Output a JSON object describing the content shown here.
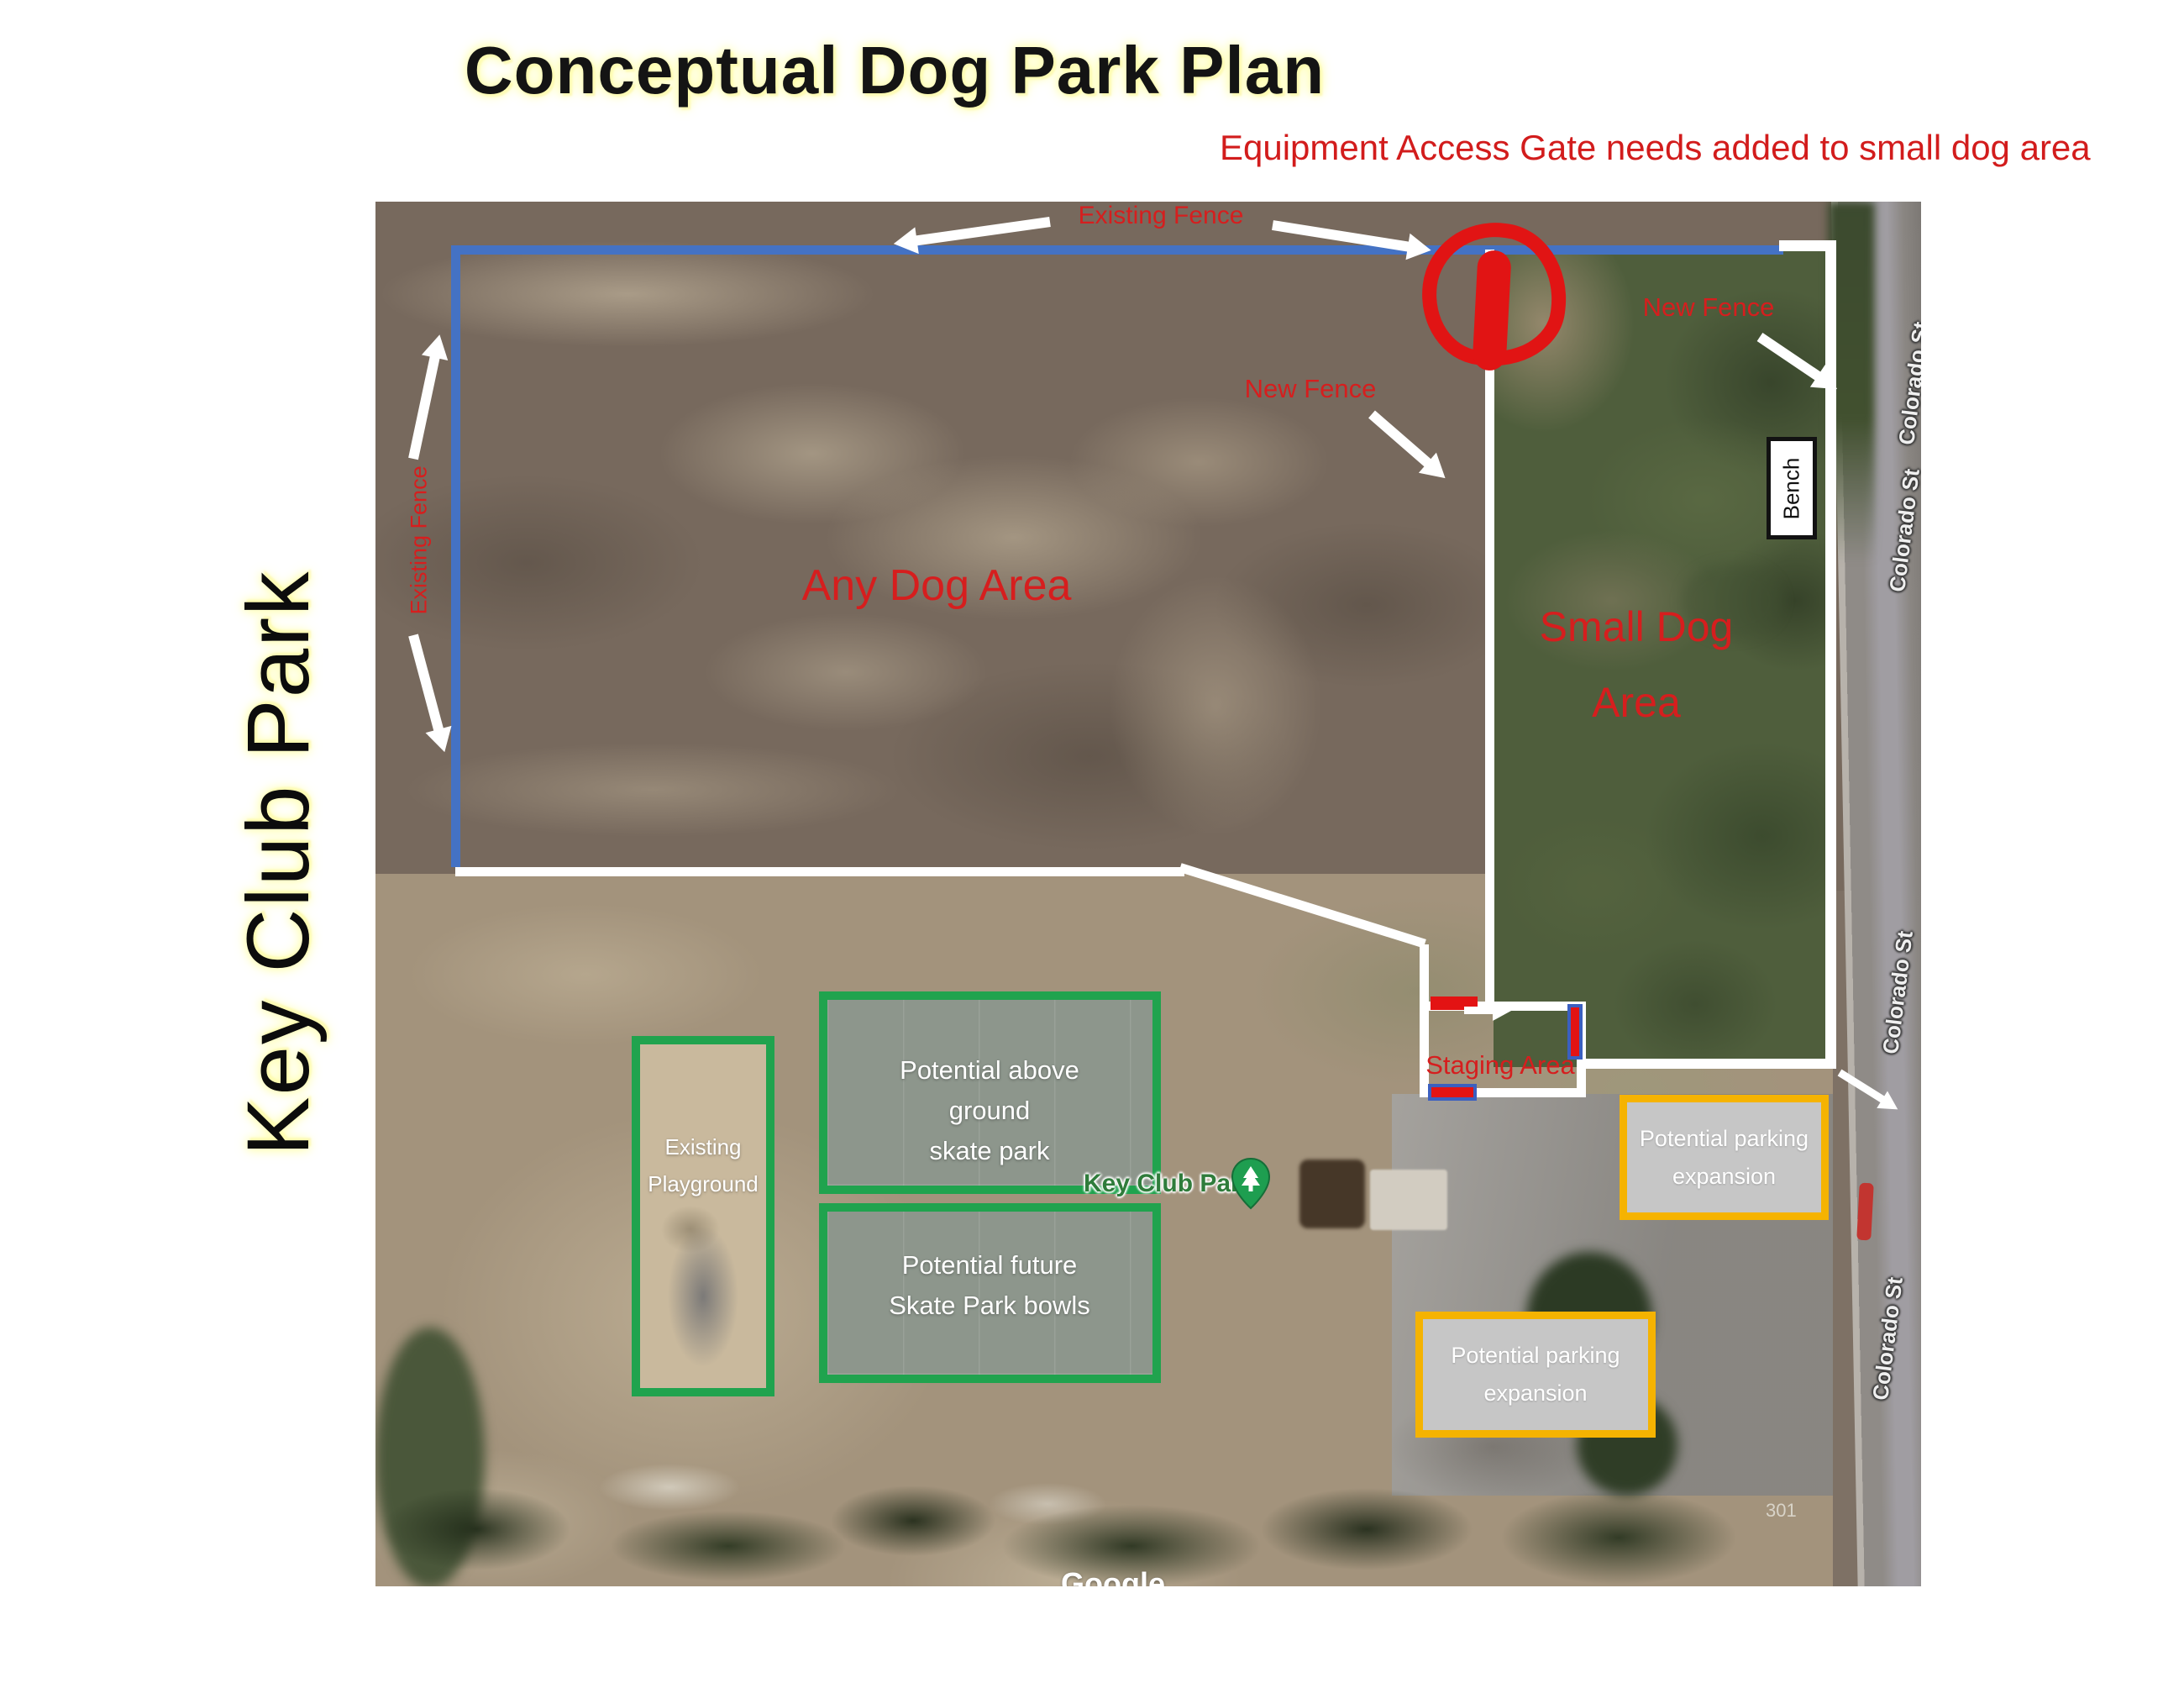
{
  "page": {
    "title": "Conceptual Dog Park Plan",
    "note": "Equipment Access Gate needs added to small dog area",
    "side_label": "Key Club Park"
  },
  "colors": {
    "annotation_red": "#d61e1e",
    "gate_red": "#e31313",
    "fence_blue": "#4472c4",
    "fence_white": "#ffffff",
    "box_green": "#20a34e",
    "parking_border": "#f5b301",
    "parking_fill": "#c6c6c6",
    "poi_green": "#2f7c3b"
  },
  "fences": {
    "existing_top": "Existing Fence",
    "existing_left": "Existing Fence",
    "new_mid": "New Fence",
    "new_right": "New Fence"
  },
  "areas": {
    "any_dog": "Any Dog Area",
    "small_dog_line1": "Small Dog",
    "small_dog_line2": "Area",
    "staging": "Staging Area",
    "bench": "Bench"
  },
  "features": {
    "playground": {
      "line1": "Existing",
      "line2": "Playground"
    },
    "skate_above": {
      "line1": "Potential above",
      "line2": "ground",
      "line3": "skate park"
    },
    "skate_bowls": {
      "line1": "Potential future",
      "line2": "Skate Park bowls"
    },
    "parking_right": {
      "line1": "Potential parking",
      "line2": "expansion"
    },
    "parking_lower": {
      "line1": "Potential parking",
      "line2": "expansion"
    }
  },
  "map": {
    "poi_label": "Key Club Park",
    "street_labels": [
      "Colorado St",
      "Colorado St",
      "Colorado St",
      "Colorado St"
    ],
    "watermark": "Google",
    "parcel_number": "301"
  }
}
